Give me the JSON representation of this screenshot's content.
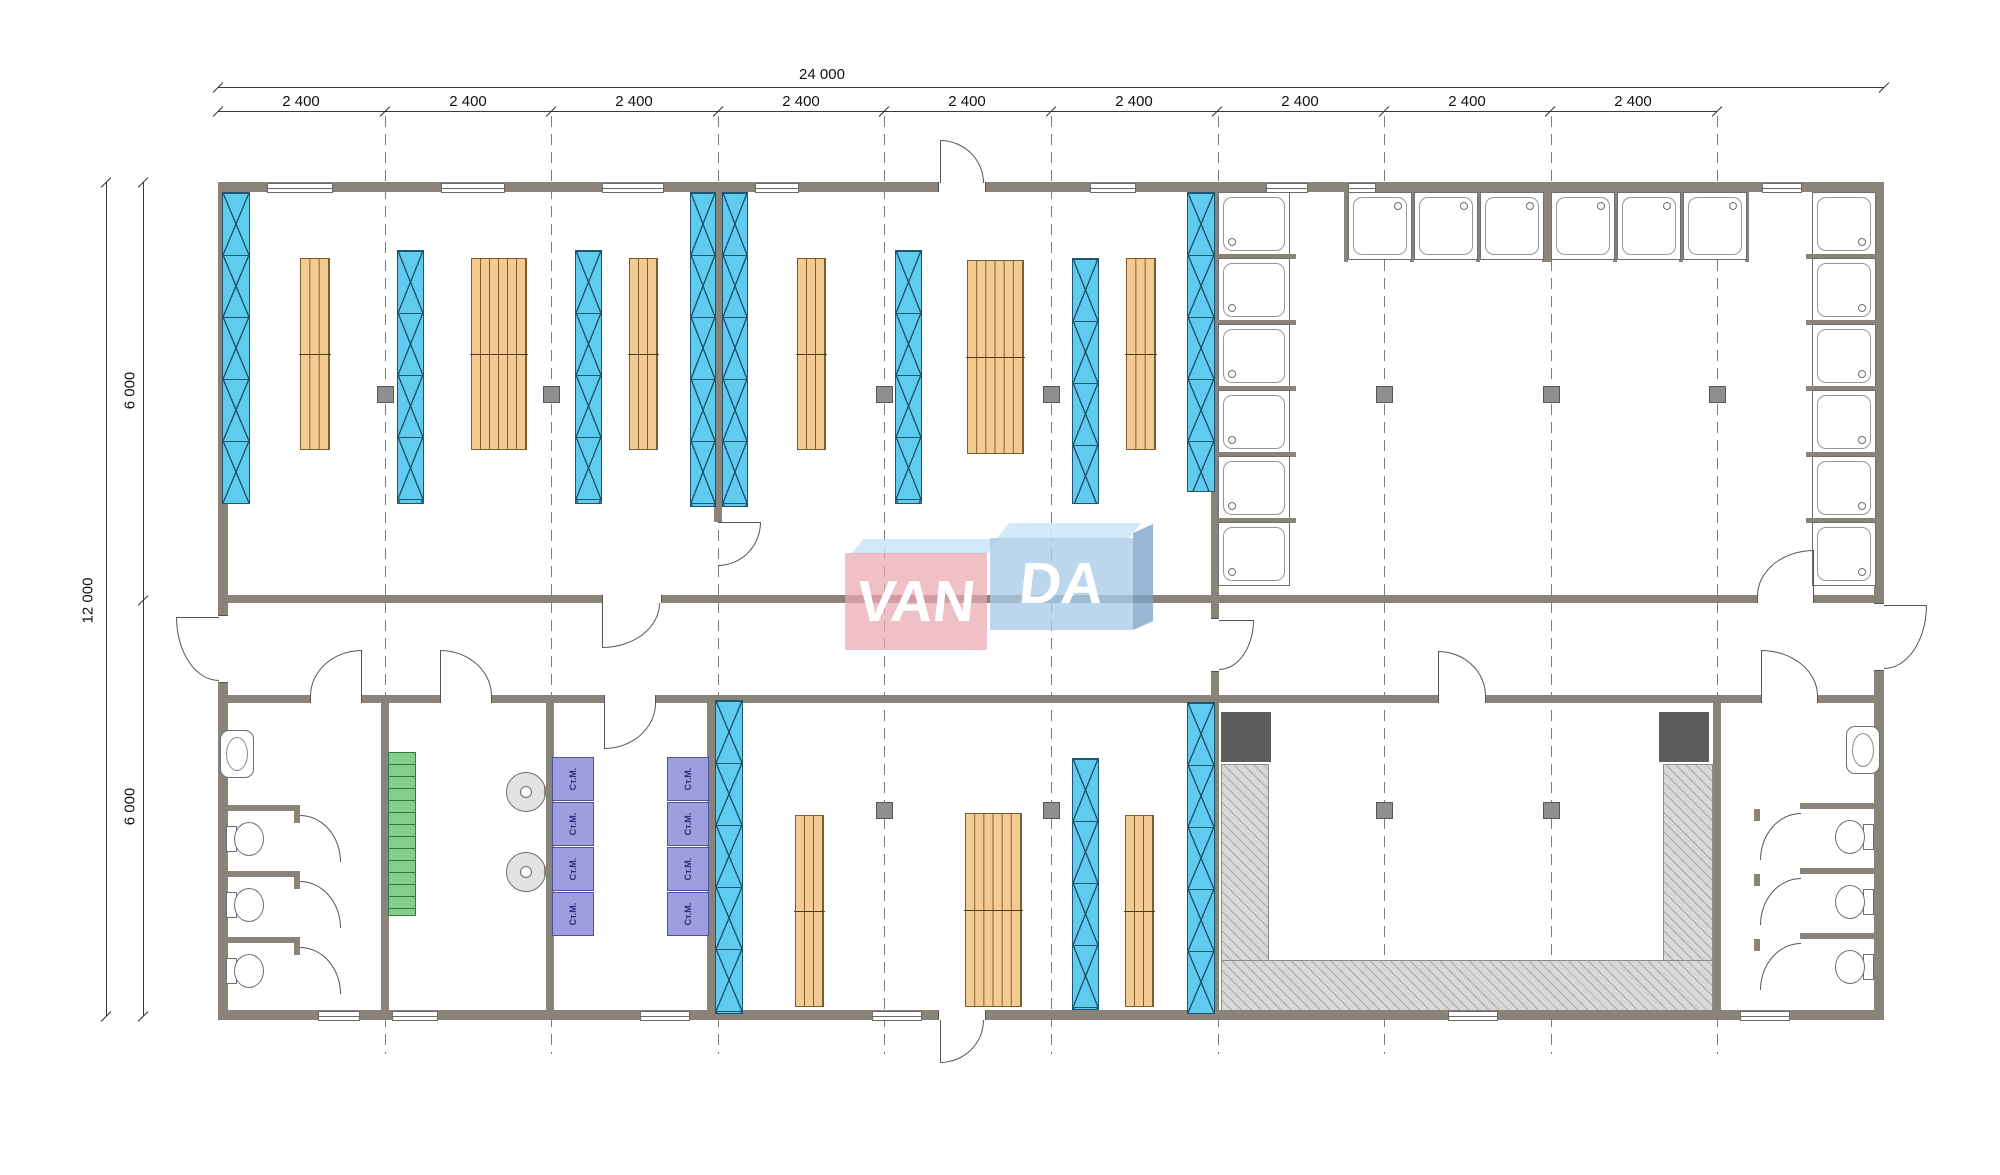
{
  "drawing": {
    "type": "floor-plan",
    "dimensions": {
      "top_total": "24 000",
      "top_segments": [
        "2 400",
        "2 400",
        "2 400",
        "2 400",
        "2 400",
        "2 400",
        "2 400",
        "2 400",
        "2 400"
      ],
      "left_total": "12 000",
      "left_segments": [
        "6 000",
        "6 000"
      ]
    },
    "equipment": {
      "washing_machine_label": "Ст.М."
    },
    "logo": {
      "part1": "VAN",
      "part2": "DA"
    },
    "colors": {
      "wall": "#8a8379",
      "rack_blue": "#5fccef",
      "rack_wood": "#f3cb92",
      "stairs_green": "#84cf8e",
      "washer_purple": "#9d9ede",
      "platform_hatch": "#d8d8d6",
      "equipment_dark": "#5d5d5d",
      "logo_pink": "#eaa7b2",
      "logo_blue": "#a9cce8"
    }
  }
}
